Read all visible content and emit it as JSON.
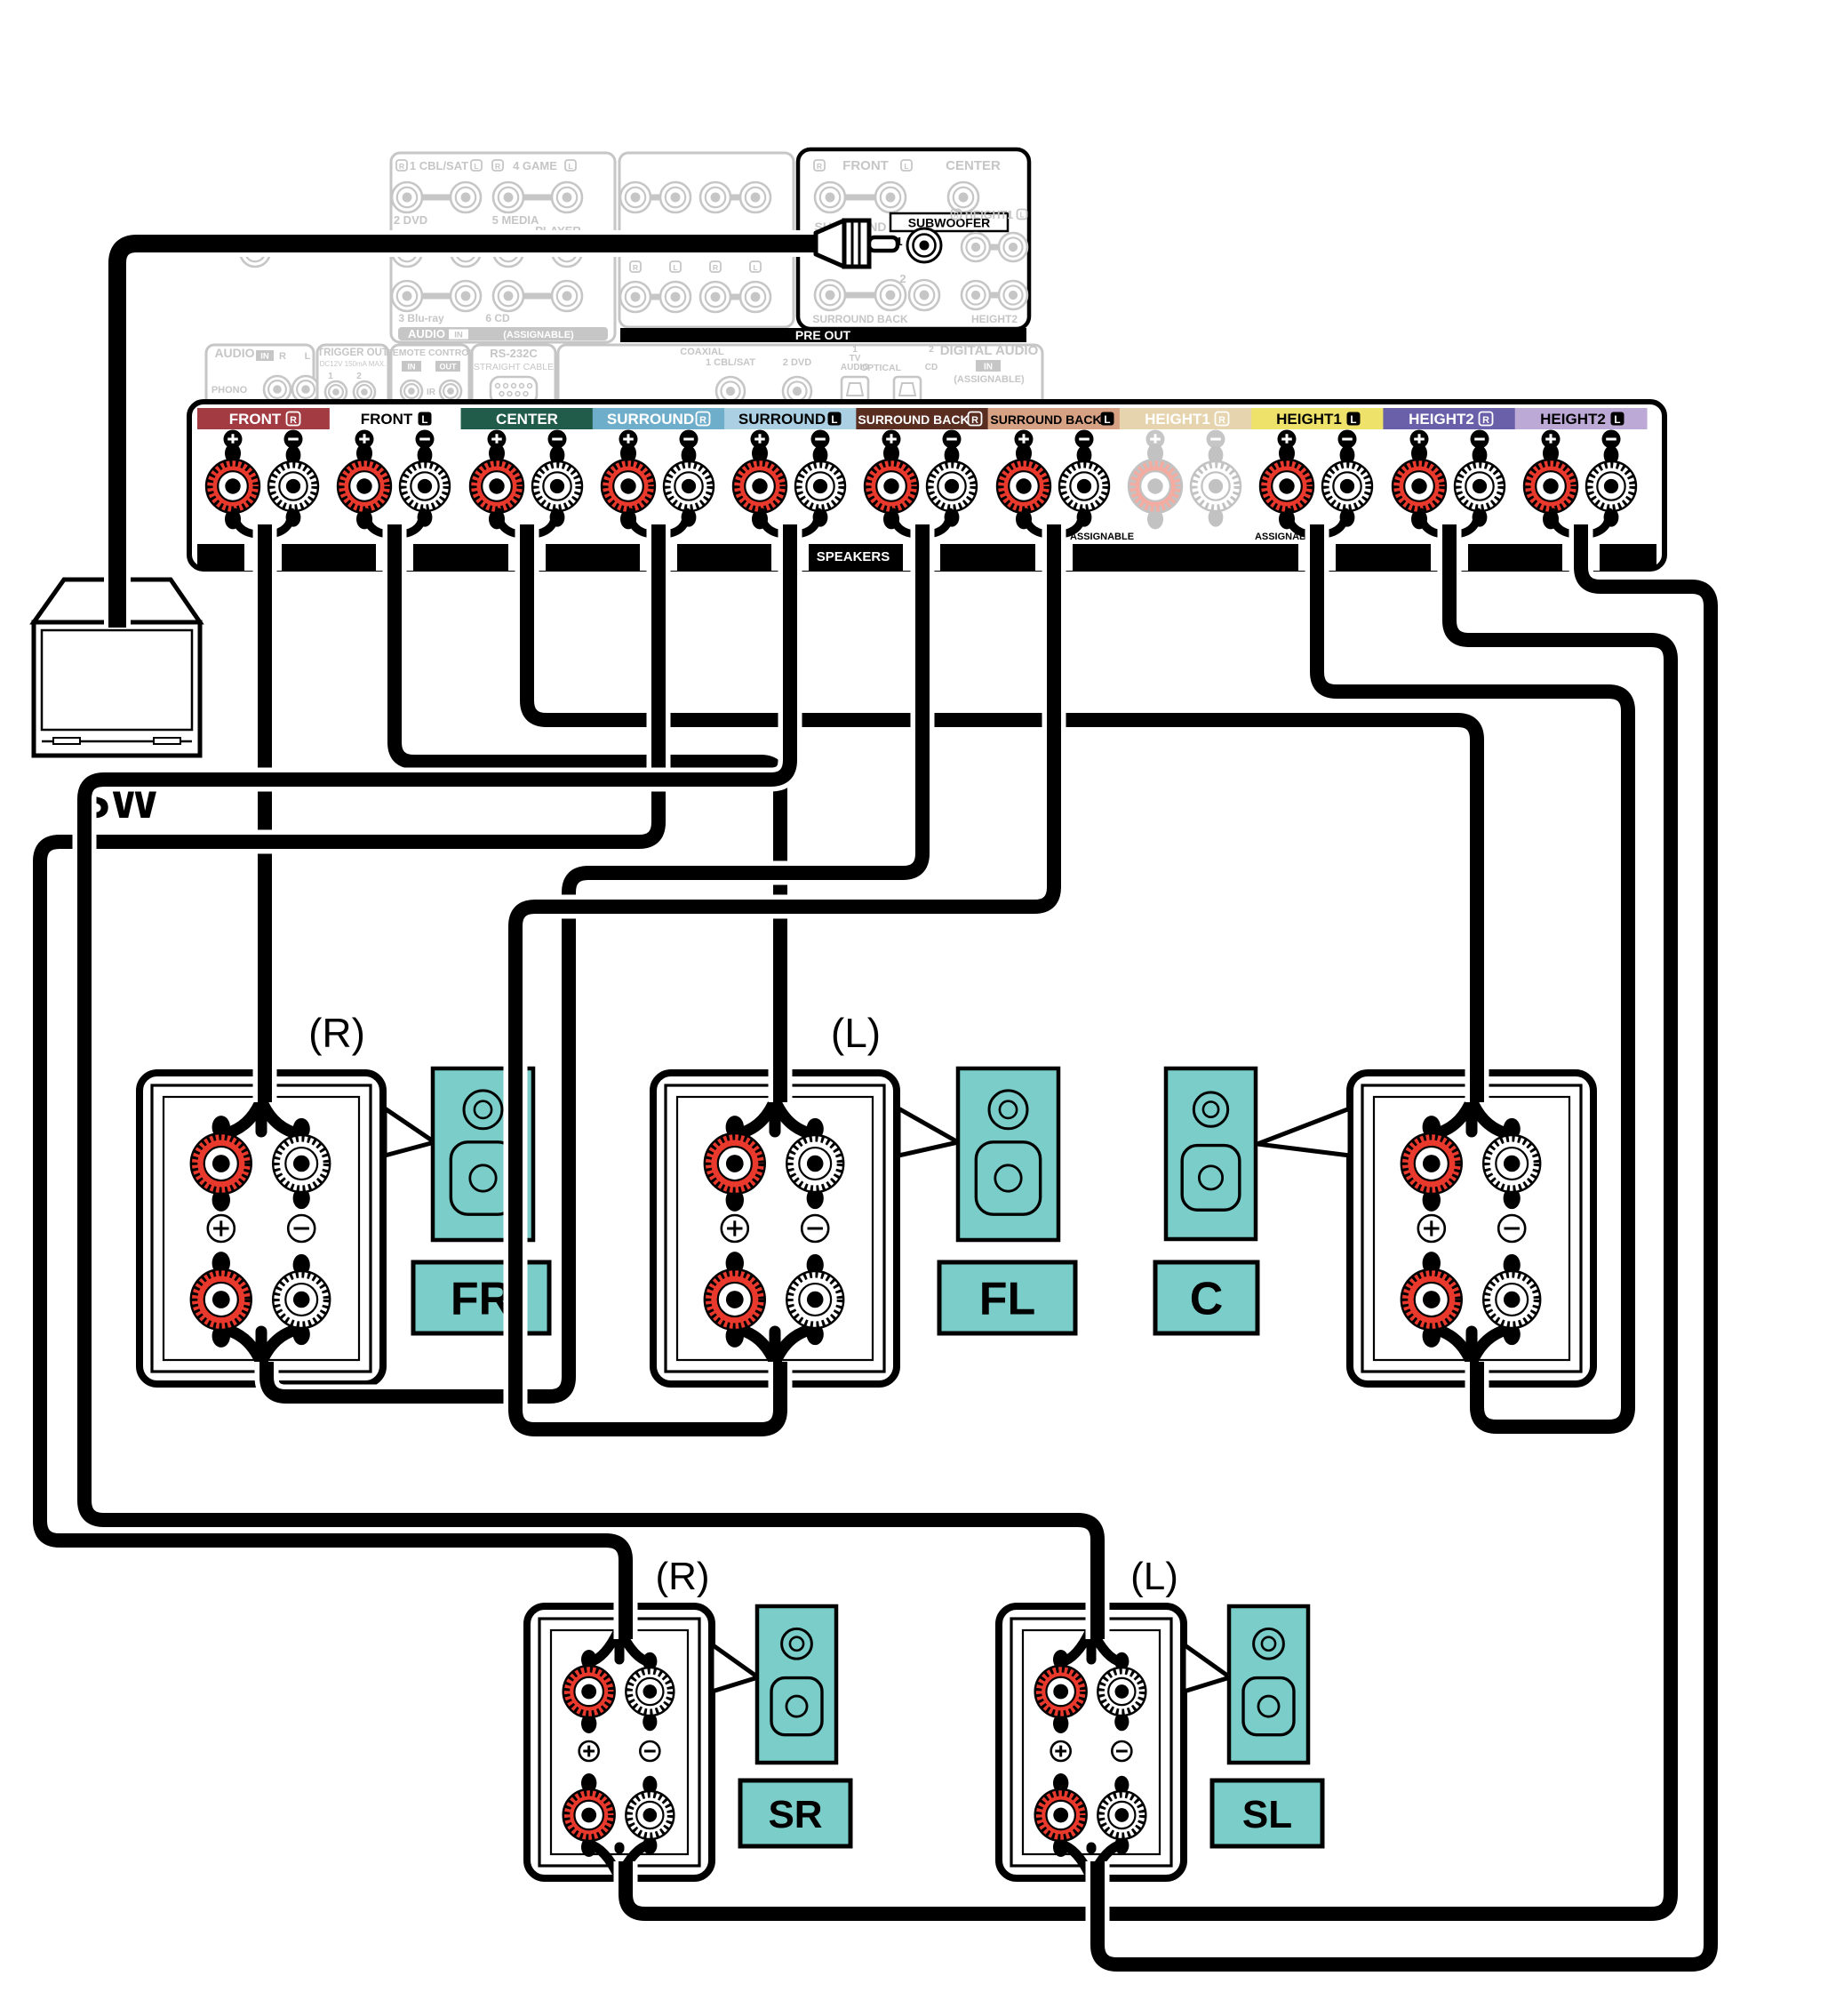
{
  "colors": {
    "teal": "#7BCDC9",
    "faded": "#c6c6c6",
    "black": "#000000",
    "white": "#ffffff",
    "post_red": "#E8392C",
    "post_red_faded": "#F2ACA2",
    "post_faded_stroke": "#c2c2c2"
  },
  "subwoofer_unit": {
    "label": "SW"
  },
  "rear_panel": {
    "audio_in_panel": {
      "row1": {
        "r": "R",
        "input1": "1 CBL/SAT",
        "l": "L",
        "r2": "R",
        "input4": "4 GAME",
        "l2": "L"
      },
      "row2": {
        "input2": "2 DVD",
        "input5a": "5 MEDIA",
        "input5b": "PLAYER"
      },
      "row3": {
        "input3": "3 Blu-ray",
        "input6": "6 CD"
      },
      "bar": {
        "audio": "AUDIO",
        "in": "IN",
        "assignable": "(ASSIGNABLE)"
      }
    },
    "preout_left_labels": [
      "R",
      "L",
      "R",
      "L"
    ],
    "preout_panel": {
      "r": "R",
      "front": "FRONT",
      "l": "L",
      "center": "CENTER",
      "surround": "SURROUND",
      "subwoofer": "SUBWOOFER",
      "one": "1",
      "two": "2",
      "height1": "HEIGHT1",
      "surround_back": "SURROUND BACK",
      "height2": "HEIGHT2",
      "bar": "PRE OUT"
    },
    "small_panels": {
      "audio": {
        "title": "AUDIO",
        "in": "IN",
        "r": "R",
        "l": "L",
        "phono": "PHONO"
      },
      "trigger": {
        "title": "TRIGGER OUT",
        "sub": "DC12V 150mA MAX.",
        "one": "1",
        "two": "2"
      },
      "remote": {
        "title": "REMOTE CONTROL",
        "in": "IN",
        "out": "OUT",
        "ir": "IR"
      },
      "rs232": {
        "title": "RS-232C",
        "sub": "STRAIGHT CABLE"
      },
      "digital": {
        "coaxial": "COAXIAL",
        "cbl": "1 CBL/SAT",
        "dvd": "2 DVD",
        "one": "1",
        "tv": "TV",
        "audio": "AUDIO",
        "optical": "OPTICAL",
        "two": "2",
        "cd": "CD",
        "title": "DIGITAL AUDIO",
        "in": "IN",
        "assignable": "(ASSIGNABLE)"
      }
    }
  },
  "speaker_strip": {
    "plus": "+",
    "minus": "−",
    "speakers": "SPEAKERS",
    "assignable": "ASSIGNABLE",
    "channels": [
      {
        "label": "FRONT",
        "pos": "R",
        "bg": "#A23C42",
        "fg": "#ffffff",
        "glyph": "outline",
        "active": true
      },
      {
        "label": "FRONT",
        "pos": "L",
        "bg": "none",
        "fg": "#000000",
        "glyph": "solid",
        "active": true
      },
      {
        "label": "CENTER",
        "pos": "",
        "bg": "#215B49",
        "fg": "#ffffff",
        "glyph": "none",
        "active": true
      },
      {
        "label": "SURROUND",
        "pos": "R",
        "bg": "#6FAECB",
        "fg": "#ffffff",
        "glyph": "outline",
        "active": true
      },
      {
        "label": "SURROUND",
        "pos": "L",
        "bg": "#ABD0E4",
        "fg": "#000000",
        "glyph": "solid",
        "active": true
      },
      {
        "label": "SURROUND BACK",
        "pos": "R",
        "bg": "#5A2D21",
        "fg": "#ffffff",
        "glyph": "outline",
        "active": true
      },
      {
        "label": "SURROUND BACK",
        "pos": "L",
        "bg": "#D7A284",
        "fg": "#000000",
        "glyph": "solid",
        "active": true
      },
      {
        "label": "HEIGHT1",
        "pos": "R",
        "bg": "#E6D4AE",
        "fg": "#ffffff",
        "glyph": "outline",
        "active": false
      },
      {
        "label": "HEIGHT1",
        "pos": "L",
        "bg": "#EEE26A",
        "fg": "#000000",
        "glyph": "solid",
        "active": true
      },
      {
        "label": "HEIGHT2",
        "pos": "R",
        "bg": "#6A5FA9",
        "fg": "#ffffff",
        "glyph": "outline",
        "active": true
      },
      {
        "label": "HEIGHT2",
        "pos": "L",
        "bg": "#BCA9D6",
        "fg": "#000000",
        "glyph": "solid",
        "active": true
      }
    ]
  },
  "speakers": [
    {
      "id": "FR",
      "header": "(R)",
      "label": "FR"
    },
    {
      "id": "FL",
      "header": "(L)",
      "label": "FL"
    },
    {
      "id": "C",
      "header": "",
      "label": "C"
    },
    {
      "id": "SR",
      "header": "(R)",
      "label": "SR"
    },
    {
      "id": "SL",
      "header": "(L)",
      "label": "SL"
    }
  ],
  "connections": [
    {
      "from": "PRE OUT SUBWOOFER 1",
      "to": "SW"
    },
    {
      "from": "FRONT R",
      "to": "FR top terminals"
    },
    {
      "from": "FRONT L",
      "to": "FL top terminals"
    },
    {
      "from": "CENTER",
      "to": "C top terminals"
    },
    {
      "from": "SURROUND R",
      "to": "SR top terminals"
    },
    {
      "from": "SURROUND L",
      "to": "SL top terminals"
    },
    {
      "from": "SURROUND BACK R",
      "to": "FR bottom terminals"
    },
    {
      "from": "SURROUND BACK L",
      "to": "FL bottom terminals"
    },
    {
      "from": "HEIGHT1 L",
      "to": "C bottom terminals"
    },
    {
      "from": "HEIGHT2 R",
      "to": "SR bottom terminals"
    },
    {
      "from": "HEIGHT2 L",
      "to": "SL bottom terminals"
    }
  ]
}
